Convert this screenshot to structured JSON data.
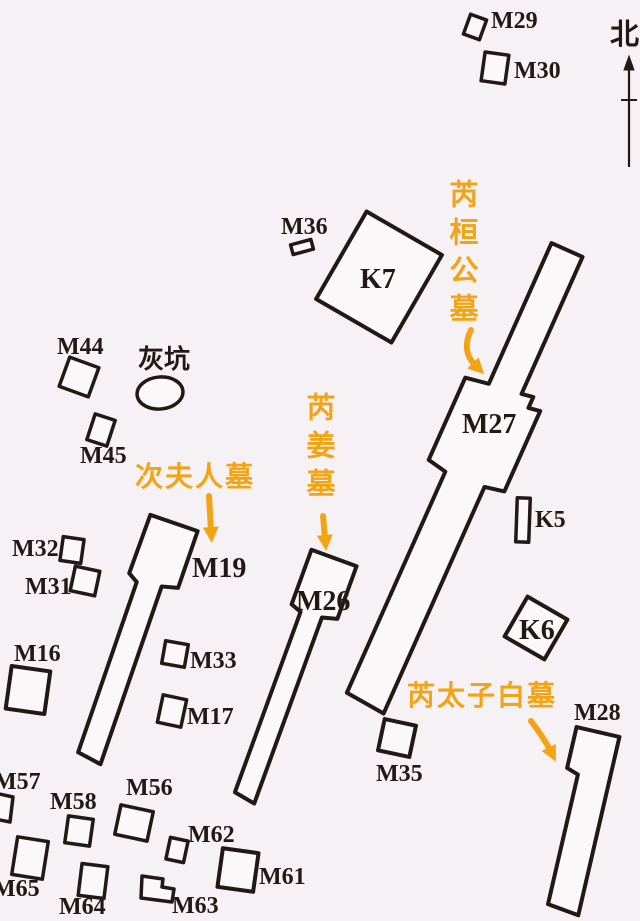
{
  "meta": {
    "description": "Archaeological cemetery site plan with numbered tombs (M), pits (K), an ash pit, orange tomb-owner annotations and a north arrow"
  },
  "colors": {
    "background": "#f6f1f5",
    "ink": "#211a14",
    "accent_orange": "#f2a414",
    "shape_fill": "#fbf8fa"
  },
  "compass": {
    "north_label": "北"
  },
  "annotations": {
    "rui_huan_gong_mu": {
      "text": "芮桓公墓",
      "orientation": "vertical",
      "color": "#f2a414"
    },
    "rui_jiang_mu": {
      "text": "芮姜墓",
      "orientation": "vertical",
      "color": "#f2a414"
    },
    "ci_fu_ren_mu": {
      "text": "次夫人墓",
      "orientation": "horizontal",
      "color": "#f2a414"
    },
    "rui_tai_zi_bai_mu": {
      "text": "芮太子白墓",
      "orientation": "horizontal",
      "color": "#f2a414"
    }
  },
  "features": {
    "m29": {
      "label": "M29"
    },
    "m30": {
      "label": "M30"
    },
    "m36": {
      "label": "M36"
    },
    "k7": {
      "label": "K7"
    },
    "m44": {
      "label": "M44"
    },
    "ash_pit": {
      "label": "灰坑"
    },
    "m45": {
      "label": "M45"
    },
    "m32": {
      "label": "M32"
    },
    "m31": {
      "label": "M31"
    },
    "m16": {
      "label": "M16"
    },
    "m19": {
      "label": "M19"
    },
    "m33": {
      "label": "M33"
    },
    "m17": {
      "label": "M17"
    },
    "m26": {
      "label": "M26"
    },
    "m27": {
      "label": "M27"
    },
    "k5": {
      "label": "K5"
    },
    "k6": {
      "label": "K6"
    },
    "m28": {
      "label": "M28"
    },
    "m35": {
      "label": "M35"
    },
    "m57": {
      "label": "M57"
    },
    "m58": {
      "label": "M58"
    },
    "m56": {
      "label": "M56"
    },
    "m62": {
      "label": "M62"
    },
    "m61": {
      "label": "M61"
    },
    "m65": {
      "label": "M65"
    },
    "m64": {
      "label": "M64"
    },
    "m63": {
      "label": "M63"
    }
  }
}
